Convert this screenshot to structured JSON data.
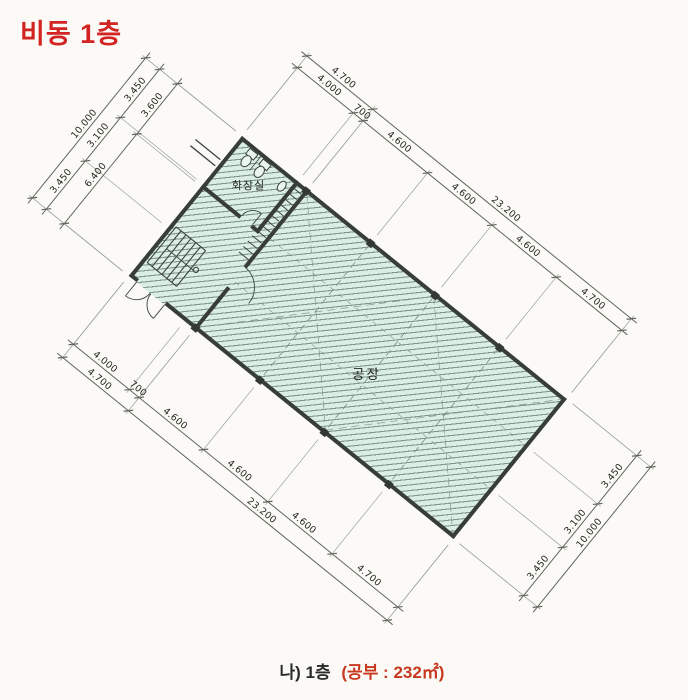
{
  "title": "비동 1층",
  "caption": {
    "prefix": "나) 1층",
    "area_note": "(공부 : 232㎡)"
  },
  "rooms": {
    "factory": "공장",
    "toilet": "화장실"
  },
  "dimensions": {
    "ne_inner": [
      "4.000",
      "700",
      "4.600",
      "4.600",
      "4.600",
      "4.700"
    ],
    "ne_outer": [
      "4.700",
      "23.200"
    ],
    "sw_inner": [
      "4.000",
      "700",
      "4.600",
      "4.600",
      "4.600",
      "4.700"
    ],
    "sw_outer": [
      "4.700",
      "23.200"
    ],
    "nw_inner": [
      "3.600",
      "6.400"
    ],
    "nw_mid": [
      "3.450",
      "3.100",
      "3.450"
    ],
    "nw_outer": [
      "10.000"
    ],
    "se_inner": [
      "3.450",
      "3.100",
      "3.450"
    ],
    "se_outer": [
      "10.000"
    ]
  },
  "colors": {
    "title_red": "#d32424",
    "caption_red": "#c8371f",
    "plan_fill_mint": "#daeee3",
    "hatch_line": "#3a4e44",
    "wall": "#383d3a",
    "dim_line": "#61655e",
    "paper": "#fbfaf6"
  }
}
